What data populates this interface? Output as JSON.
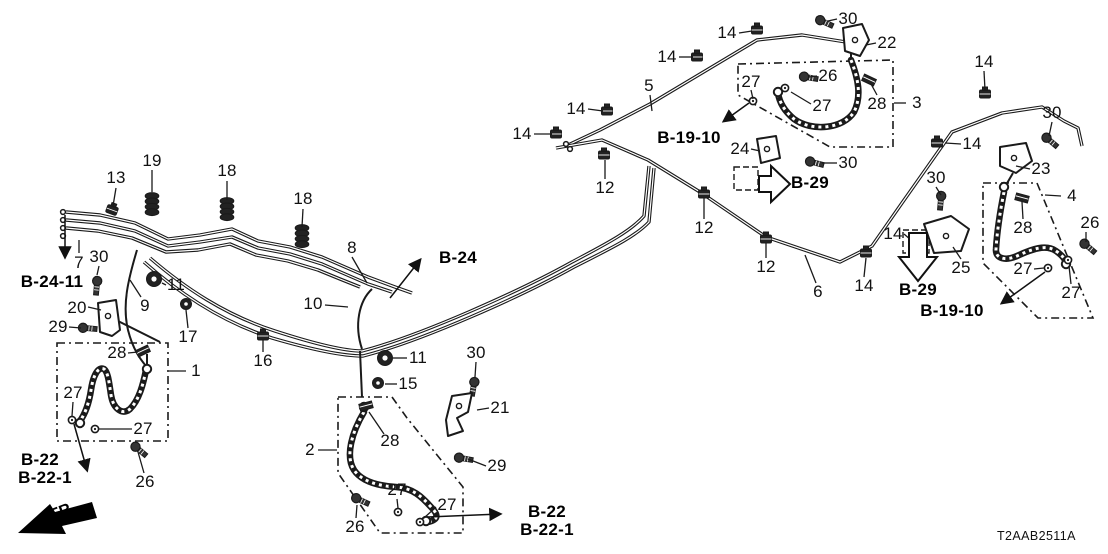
{
  "diagram": {
    "title": "Brake lines parts diagram",
    "part_code": "T2AAB2511A",
    "fr_label": "FR.",
    "line_color": "#1a1a1a",
    "callouts": [
      {
        "t": "13",
        "x": 116,
        "y": 178
      },
      {
        "t": "19",
        "x": 152,
        "y": 161
      },
      {
        "t": "18",
        "x": 227,
        "y": 171
      },
      {
        "t": "18",
        "x": 303,
        "y": 199
      },
      {
        "t": "7",
        "x": 79,
        "y": 263
      },
      {
        "t": "30",
        "x": 99,
        "y": 257
      },
      {
        "t": "20",
        "x": 77,
        "y": 308
      },
      {
        "t": "29",
        "x": 58,
        "y": 327
      },
      {
        "t": "11",
        "x": 176,
        "y": 285
      },
      {
        "t": "9",
        "x": 145,
        "y": 306
      },
      {
        "t": "17",
        "x": 188,
        "y": 337
      },
      {
        "t": "28",
        "x": 117,
        "y": 353
      },
      {
        "t": "1",
        "x": 196,
        "y": 371
      },
      {
        "t": "27",
        "x": 73,
        "y": 393
      },
      {
        "t": "27",
        "x": 143,
        "y": 429
      },
      {
        "t": "26",
        "x": 145,
        "y": 482
      },
      {
        "t": "8",
        "x": 352,
        "y": 248
      },
      {
        "t": "10",
        "x": 313,
        "y": 304
      },
      {
        "t": "16",
        "x": 263,
        "y": 361
      },
      {
        "t": "11",
        "x": 418,
        "y": 358
      },
      {
        "t": "15",
        "x": 408,
        "y": 384
      },
      {
        "t": "30",
        "x": 476,
        "y": 353
      },
      {
        "t": "21",
        "x": 500,
        "y": 408
      },
      {
        "t": "2",
        "x": 310,
        "y": 450
      },
      {
        "t": "28",
        "x": 390,
        "y": 441
      },
      {
        "t": "29",
        "x": 497,
        "y": 466
      },
      {
        "t": "27",
        "x": 397,
        "y": 490
      },
      {
        "t": "27",
        "x": 447,
        "y": 505
      },
      {
        "t": "26",
        "x": 355,
        "y": 527
      },
      {
        "t": "14",
        "x": 522,
        "y": 134
      },
      {
        "t": "14",
        "x": 576,
        "y": 109
      },
      {
        "t": "5",
        "x": 649,
        "y": 86
      },
      {
        "t": "14",
        "x": 667,
        "y": 57
      },
      {
        "t": "14",
        "x": 727,
        "y": 33
      },
      {
        "t": "27",
        "x": 751,
        "y": 82
      },
      {
        "t": "24",
        "x": 740,
        "y": 149
      },
      {
        "t": "12",
        "x": 605,
        "y": 188
      },
      {
        "t": "12",
        "x": 704,
        "y": 228
      },
      {
        "t": "12",
        "x": 766,
        "y": 267
      },
      {
        "t": "30",
        "x": 848,
        "y": 19
      },
      {
        "t": "22",
        "x": 887,
        "y": 43
      },
      {
        "t": "26",
        "x": 828,
        "y": 76
      },
      {
        "t": "27",
        "x": 822,
        "y": 106
      },
      {
        "t": "28",
        "x": 877,
        "y": 104
      },
      {
        "t": "3",
        "x": 917,
        "y": 103
      },
      {
        "t": "30",
        "x": 848,
        "y": 163
      },
      {
        "t": "6",
        "x": 818,
        "y": 292
      },
      {
        "t": "14",
        "x": 864,
        "y": 286
      },
      {
        "t": "14",
        "x": 984,
        "y": 62
      },
      {
        "t": "30",
        "x": 1052,
        "y": 113
      },
      {
        "t": "14",
        "x": 972,
        "y": 144
      },
      {
        "t": "23",
        "x": 1041,
        "y": 169
      },
      {
        "t": "30",
        "x": 936,
        "y": 178
      },
      {
        "t": "4",
        "x": 1072,
        "y": 196
      },
      {
        "t": "28",
        "x": 1023,
        "y": 228
      },
      {
        "t": "26",
        "x": 1090,
        "y": 223
      },
      {
        "t": "14",
        "x": 893,
        "y": 234
      },
      {
        "t": "25",
        "x": 961,
        "y": 268
      },
      {
        "t": "27",
        "x": 1023,
        "y": 269
      },
      {
        "t": "27",
        "x": 1071,
        "y": 293
      }
    ],
    "refs": [
      {
        "t": "B-24-11",
        "x": 52,
        "y": 282
      },
      {
        "t": "B-22",
        "x": 40,
        "y": 460
      },
      {
        "t": "B-22-1",
        "x": 45,
        "y": 478
      },
      {
        "t": "B-24",
        "x": 458,
        "y": 258
      },
      {
        "t": "B-22",
        "x": 547,
        "y": 512
      },
      {
        "t": "B-22-1",
        "x": 547,
        "y": 530
      },
      {
        "t": "B-19-10",
        "x": 689,
        "y": 138
      },
      {
        "t": "B-29",
        "x": 810,
        "y": 183
      },
      {
        "t": "B-29",
        "x": 918,
        "y": 290
      },
      {
        "t": "B-19-10",
        "x": 952,
        "y": 311
      }
    ]
  }
}
